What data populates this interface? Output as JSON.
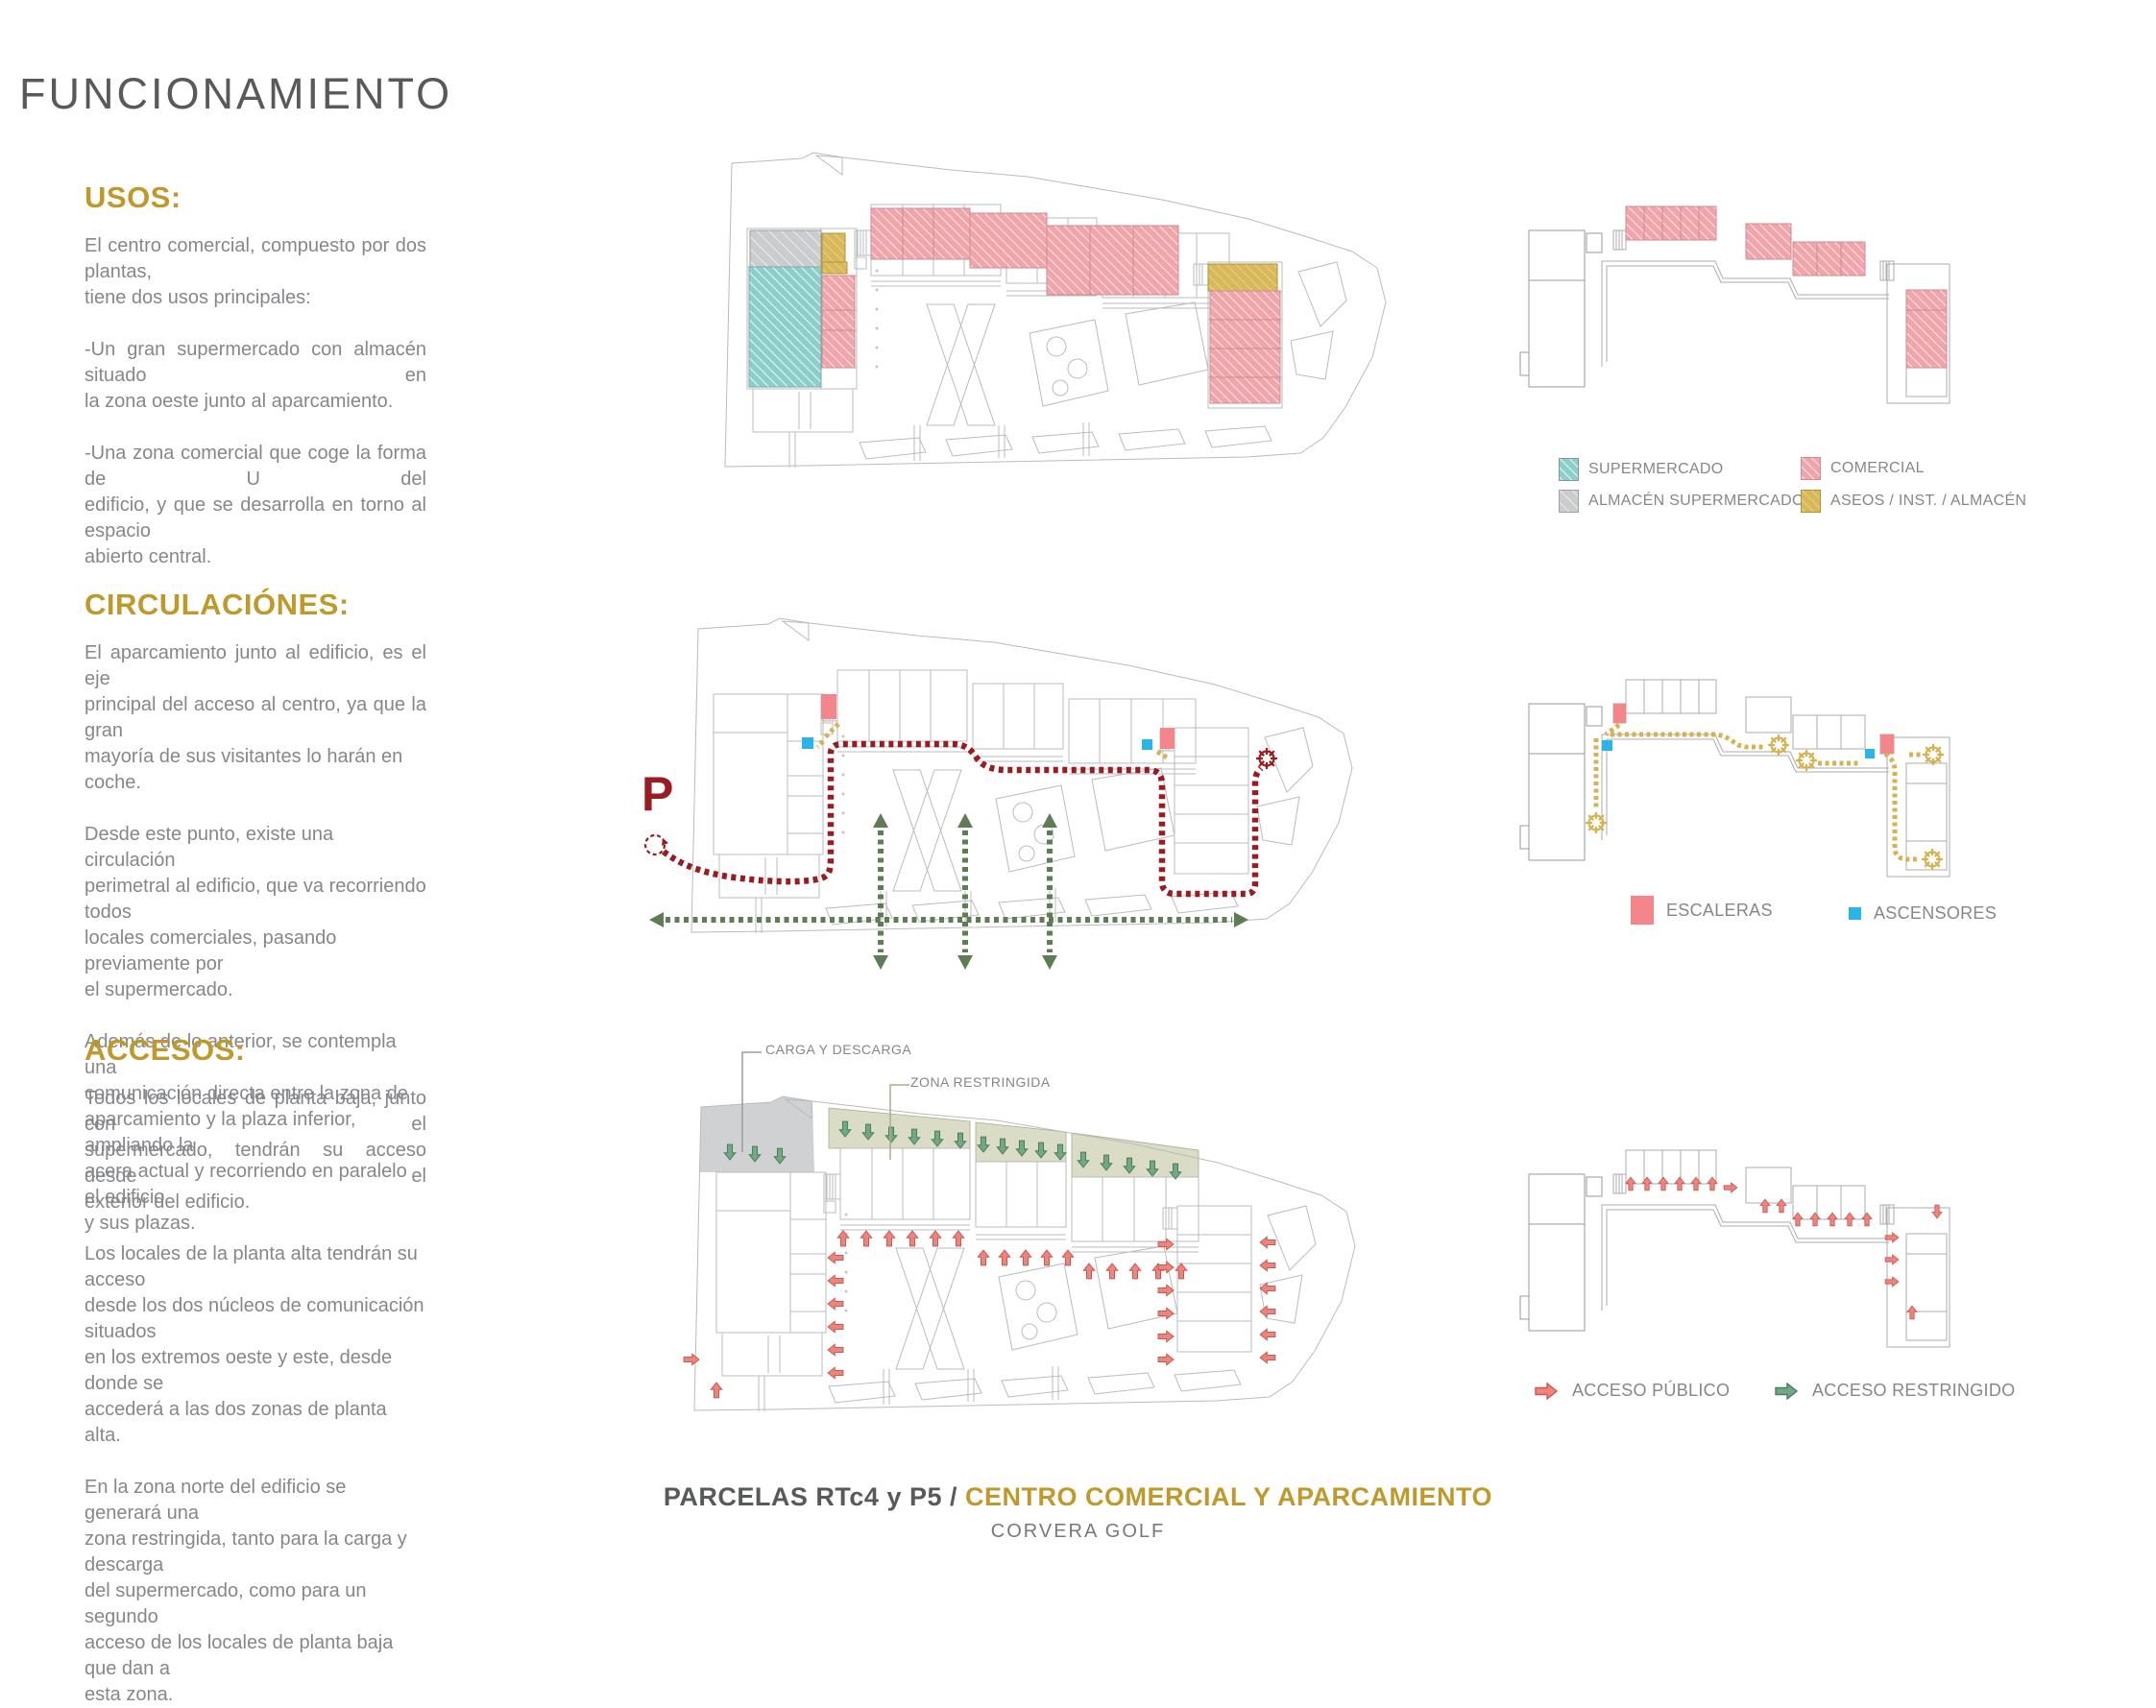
{
  "page": {
    "title": "FUNCIONAMIENTO"
  },
  "sections": {
    "usos": {
      "heading": "USOS:",
      "paragraphs": [
        {
          "lines": [
            {
              "t": "El centro comercial, compuesto por dos plantas,",
              "s": true
            },
            {
              "t": "tiene dos usos principales:",
              "s": false
            }
          ]
        },
        {
          "lines": [
            {
              "t": "-Un gran supermercado con almacén situado en",
              "s": true
            },
            {
              "t": "la zona oeste junto al aparcamiento.",
              "s": false
            }
          ]
        },
        {
          "lines": [
            {
              "t": "-Una zona comercial que coge la forma de U del",
              "s": true
            },
            {
              "t": "edificio, y que se desarrolla en torno al espacio",
              "s": true
            },
            {
              "t": "abierto central.",
              "s": false
            }
          ]
        }
      ]
    },
    "circulaciones": {
      "heading": "CIRCULACIÓNES:",
      "paragraphs": [
        {
          "lines": [
            {
              "t": "El aparcamiento junto al edificio, es el eje",
              "s": true
            },
            {
              "t": "principal del acceso al centro, ya que la gran",
              "s": true
            },
            {
              "t": "mayoría de sus visitantes lo harán en coche.",
              "s": false
            }
          ]
        },
        {
          "lines": [
            {
              "t": "Desde este punto, existe una circulación",
              "s": false
            },
            {
              "t": "perimetral al edificio, que va recorriendo todos",
              "s": false
            },
            {
              "t": "locales comerciales, pasando previamente por",
              "s": false
            },
            {
              "t": "el supermercado.",
              "s": false
            }
          ]
        },
        {
          "lines": [
            {
              "t": "Además de lo anterior, se contempla una",
              "s": false
            },
            {
              "t": "comunicación directa entre la zona de",
              "s": false
            },
            {
              "t": "aparcamiento y la plaza inferior, ampliando la",
              "s": false
            },
            {
              "t": "acera actual y recorriendo en paralelo el edificio",
              "s": false
            },
            {
              "t": "y sus plazas.",
              "s": false
            }
          ]
        }
      ]
    },
    "accesos": {
      "heading": "ACCESOS:",
      "paragraphs": [
        {
          "lines": [
            {
              "t": "Todos los locales de planta baja, junto con el",
              "s": true
            },
            {
              "t": "supermercado, tendrán su acceso desde el",
              "s": true
            },
            {
              "t": "exterior del edificio.",
              "s": false
            }
          ]
        },
        {
          "lines": [
            {
              "t": "Los locales de la planta alta tendrán su acceso",
              "s": false
            },
            {
              "t": "desde los dos núcleos de comunicación situados",
              "s": false
            },
            {
              "t": "en los extremos oeste y este, desde donde se",
              "s": false
            },
            {
              "t": "accederá a las dos zonas de planta alta.",
              "s": false
            }
          ]
        },
        {
          "lines": [
            {
              "t": "En la zona norte del edificio se generará una",
              "s": false
            },
            {
              "t": "zona restringida, tanto para la carga y descarga",
              "s": false
            },
            {
              "t": "del supermercado, como para un segundo",
              "s": false
            },
            {
              "t": "acceso de los locales de planta baja que dan a",
              "s": false
            },
            {
              "t": "esta zona.",
              "s": false
            }
          ]
        }
      ]
    }
  },
  "plan_labels": {
    "parking": "P",
    "carga": "CARGA Y DESCARGA",
    "zona": "ZONA RESTRINGIDA"
  },
  "legends": {
    "usos": [
      {
        "label": "SUPERMERCADO",
        "color": "#8ccfca"
      },
      {
        "label": "ALMACÉN SUPERMERCADO",
        "color": "#cbccce"
      },
      {
        "label": "COMERCIAL",
        "color": "#f2a4ab"
      },
      {
        "label": "ASEOS / INST. / ALMACÉN",
        "color": "#d8b95a"
      }
    ],
    "circulaciones": [
      {
        "label": "ESCALERAS",
        "color": "#f4868b"
      },
      {
        "label": "ASCENSORES",
        "color": "#29b5e8"
      }
    ],
    "accesos": [
      {
        "label": "ACCESO PÚBLICO",
        "color": "#f0837b"
      },
      {
        "label": "ACCESO RESTRINGIDO",
        "color": "#72a883"
      }
    ]
  },
  "footer": {
    "part1": "PARCELAS RTc4 y P5 /",
    "part2": "CENTRO COMERCIAL Y APARCAMIENTO",
    "subtitle": "CORVERA GOLF"
  },
  "colors": {
    "gold": "#c0992c",
    "titleGray": "#58595b",
    "body": "#85878a",
    "teal": "#8ccfca",
    "pink": "#f2a4ab",
    "grayfill": "#cbccce",
    "goldfill": "#d8b95a",
    "red": "#9b1c20",
    "green": "#5e7d52",
    "redA": "#f0837b",
    "greenA": "#72a883",
    "blue": "#29b5e8",
    "stairpink": "#f4868b",
    "olive": "#dadcc6",
    "carga": "#cfd1d3",
    "yellowpath": "#d6b352"
  }
}
